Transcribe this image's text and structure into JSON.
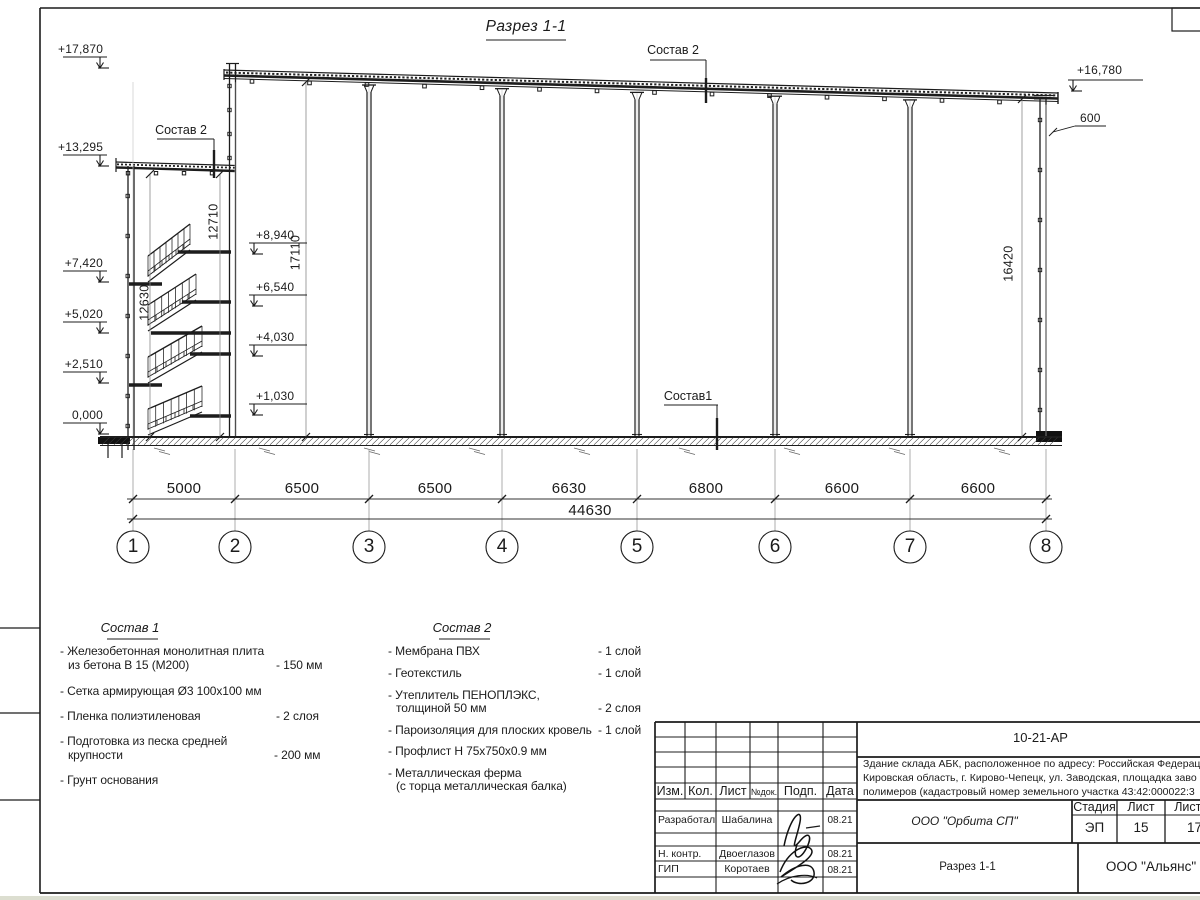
{
  "sheet": {
    "title": "Разрез 1-1",
    "composition_labels": {
      "top": "Состав 2",
      "left": "Состав 2",
      "floor": "Состав1"
    },
    "elevations": {
      "left": [
        "+17,870",
        "+13,295",
        "+7,420",
        "+5,020",
        "+2,510",
        "0,000"
      ],
      "inner": [
        "+8,940",
        "+6,540",
        "+4,030",
        "+1,030"
      ],
      "right_top": "+16,780",
      "roof_overhang": "600"
    },
    "vertical_dims": {
      "stair_inner": "12710",
      "hall": "17110",
      "stair_left": "12630",
      "right_wall": "16420"
    },
    "span_dims": [
      "5000",
      "6500",
      "6500",
      "6630",
      "6800",
      "6600",
      "6600"
    ],
    "total_dim": "44630",
    "axes": [
      "1",
      "2",
      "3",
      "4",
      "5",
      "6",
      "7",
      "8"
    ]
  },
  "composition1": {
    "title": "Состав 1",
    "items": [
      {
        "text": "- Железобетонная  монолитная плита",
        "text2": "из бетона В 15 (М200)",
        "value": "- 150 мм"
      },
      {
        "text": "- Сетка армирующая Ø3 100х100 мм",
        "text2": "",
        "value": ""
      },
      {
        "text": "- Пленка полиэтиленовая",
        "text2": "",
        "value": "-  2 слоя"
      },
      {
        "text": "- Подготовка из песка средней",
        "text2": "крупности",
        "value": "- 200 мм"
      },
      {
        "text": "- Грунт основания",
        "text2": "",
        "value": ""
      }
    ]
  },
  "composition2": {
    "title": "Состав 2",
    "items": [
      {
        "text": "- Мембрана ПВХ",
        "text2": "",
        "value": "- 1 слой"
      },
      {
        "text": "- Геотекстиль",
        "text2": "",
        "value": "- 1 слой"
      },
      {
        "text": "- Утеплитель ПЕНОПЛЭКС,",
        "text2": "толщиной 50 мм",
        "value": "- 2 слоя"
      },
      {
        "text": "- Пароизоляция для плоских кровель",
        "text2": "",
        "value": "- 1 слой"
      },
      {
        "text": "- Профлист Н 75х750х0.9 мм",
        "text2": "",
        "value": ""
      },
      {
        "text": "- Металлическая ферма",
        "text2": "(с торца металлическая балка)",
        "value": ""
      }
    ]
  },
  "titleblock": {
    "doc_number": "10-21-АР",
    "description": [
      "Здание склада АБК, расположенное по адресу: Российская Федерац",
      "Кировская область, г. Кирово-Чепецк, ул. Заводская, площадка заво",
      "полимеров (кадастровый номер земельного участка 43:42:000022:3"
    ],
    "columns": [
      "Изм.",
      "Кол.",
      "Лист",
      "№док.",
      "Подп.",
      "Дата"
    ],
    "staff": [
      {
        "role": "Разработал",
        "name": "Шабалина",
        "date": "08.21"
      },
      {
        "role": "Н. контр.",
        "name": "Двоеглазов",
        "date": "08.21"
      },
      {
        "role": "ГИП",
        "name": "Коротаев",
        "date": "08.21"
      }
    ],
    "designer_org": "ООО \"Орбита СП\"",
    "stage_label": "Стадия",
    "sheet_label": "Лист",
    "sheets_label": "Листов",
    "stage": "ЭП",
    "sheet_num": "15",
    "sheets_total": "17",
    "section_name": "Разрез 1-1",
    "customer_org": "ООО \"Альянс\""
  }
}
